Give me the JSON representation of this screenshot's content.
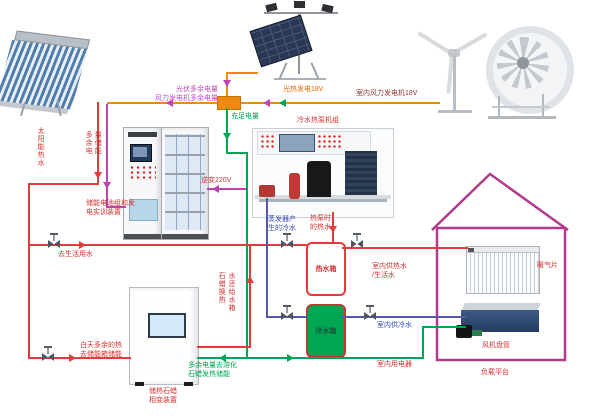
{
  "diagram_title_note": "solar / wind / heat-pump multi-energy training system schematic",
  "colors": {
    "electric_orange": "#ef8913",
    "hot_water_red": "#e23c3c",
    "power_green": "#00a651",
    "surplus_magenta": "#bb44b0",
    "cold_water_blue": "#5558a8",
    "house_outline": "#b13a8d",
    "label_red": "#d03333",
    "label_blue": "#3a4fae",
    "label_orange": "#e36c09",
    "label_darkred": "#943634",
    "cold_tank_fill": "#00a651"
  },
  "labels": {
    "solar_hot_water": "太阳能热水",
    "surplus_note": "光伏多余电量\n风力发电机多余电量",
    "pv_gen": "光热发电18V",
    "wind_gen": "室内风力发电机18V",
    "enough_power": "充足电量",
    "surplus_store": "多余电量储能",
    "battery_device": "储能电池组和发\n电实训装置",
    "inverter": "逆变220V",
    "chiller": "冷水热泵机组",
    "evap_cold": "蒸发器产\n生的冷水",
    "hp_hot": "热泵时\n的热水",
    "hot_tank": "热水箱",
    "cold_tank": "冷水箱",
    "to_domestic": "去生活用水",
    "day_surplus": "白天多余的热\n去储能箱储能",
    "paraffin_return_left": "石蜡换热",
    "paraffin_return_right": "水还给水箱",
    "melt_paraffin": "多余电量去溶化\n石蜡发热储能",
    "paraffin_device": "储热石蜡\n相变装置",
    "indoor_hot": "室内供热水\n/生活水",
    "indoor_cold": "室内供冷水",
    "indoor_elec": "室内用电器",
    "radiator": "暖气片",
    "fan_coil": "风机盘管",
    "load_platform": "负载平台"
  }
}
